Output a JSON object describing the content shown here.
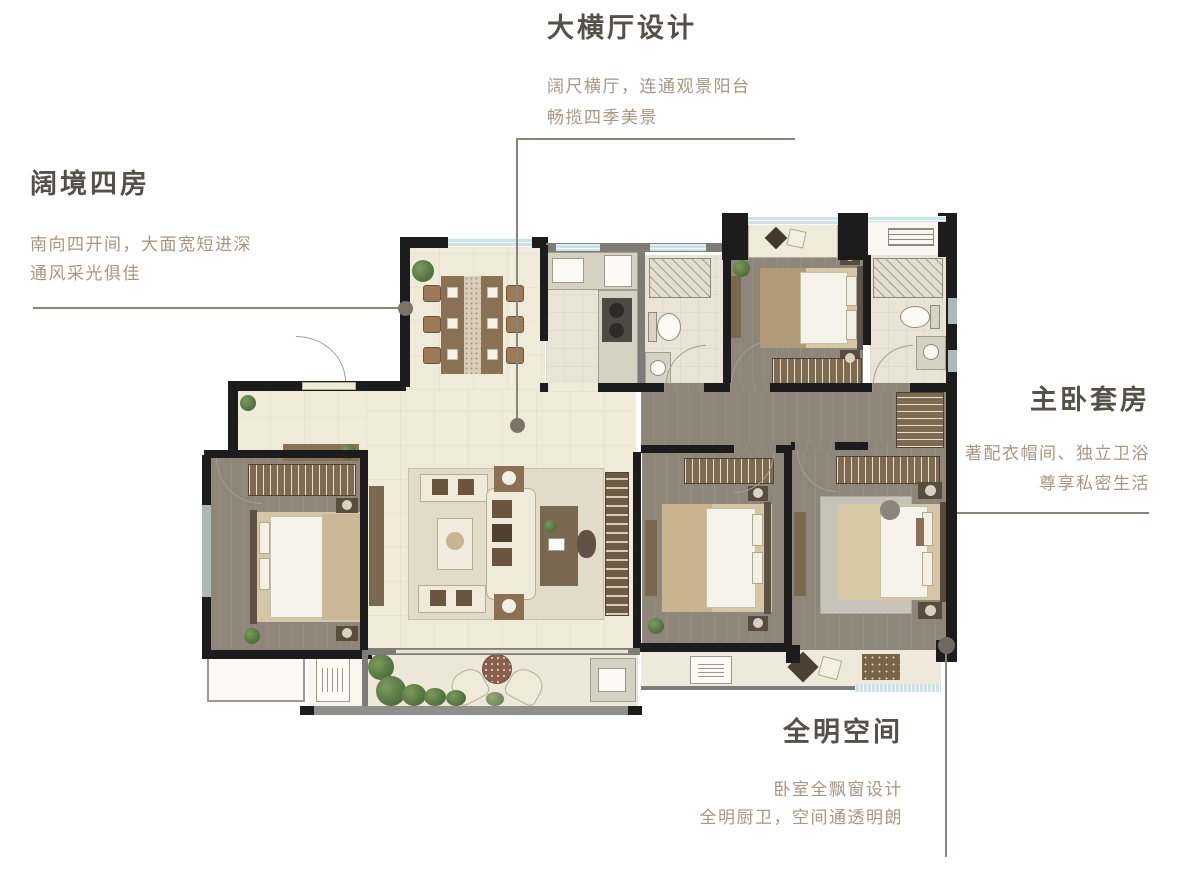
{
  "annotations": {
    "top": {
      "title": "大横厅设计",
      "line1": "阔尺横厅，连通观景阳台",
      "line2": "畅揽四季美景"
    },
    "left": {
      "title": "阔境四房",
      "line1": "南向四开间，大面宽短进深",
      "line2": "通风采光俱佳"
    },
    "right": {
      "title": "主卧套房",
      "line1": "著配衣帽间、独立卫浴",
      "line2": "尊享私密生活"
    },
    "bottom_right": {
      "title": "全明空间",
      "line1": "卧室全飘窗设计",
      "line2": "全明厨卫，空间通透明朗"
    }
  },
  "colors": {
    "title_text": "#55504a",
    "subtitle_text": "#a79681",
    "leader_line": "#8b8377",
    "wall_dark": "#1c1c1c",
    "wall_gray": "#7d7c78",
    "floor_beige": "#f0ead9",
    "floor_wood": "#8e8679",
    "floor_tile": "#e9e4d6",
    "window_blue": "#cfe3e6",
    "furniture_brown": "#8a7054",
    "plant_green": "#5e7d4a",
    "rug_gray": "#c8c3b9"
  }
}
